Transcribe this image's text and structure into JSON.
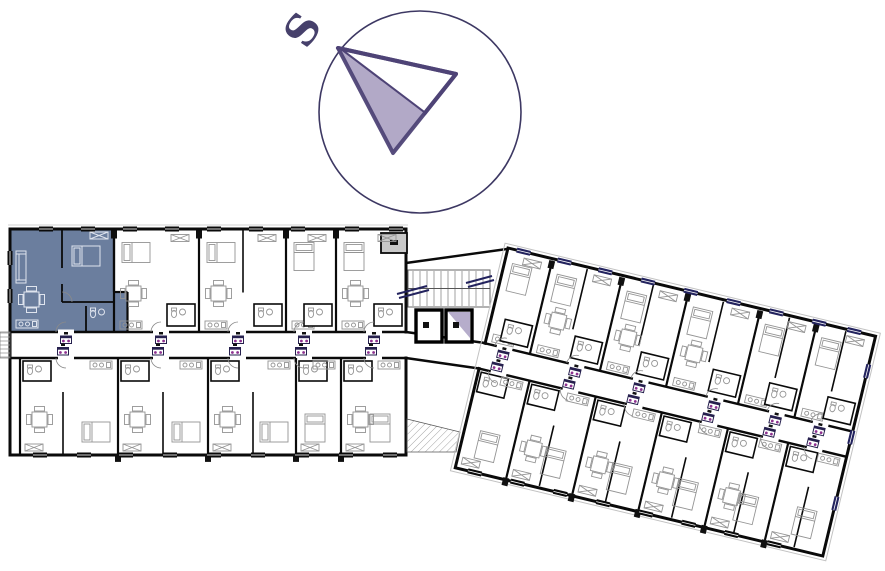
{
  "compass": {
    "label": "S"
  },
  "colors": {
    "highlight": "#6b7e9e",
    "compass_ring": "#3d3863",
    "needle_stroke": "#4e4376",
    "needle_fill": "#b2a9c7",
    "label_purple": "#46406b",
    "wall": "#0a0a0a",
    "window_accent": "#23235e",
    "badge_accent": "#8d3190",
    "badge_frame": "#26204e",
    "balcony_gray": "#c9c9c9",
    "elevator_accent": "#b6adcb",
    "furniture_line": "#949494"
  },
  "selection": {
    "selected_unit": "top-left-apartment",
    "selected_wing": "left"
  }
}
